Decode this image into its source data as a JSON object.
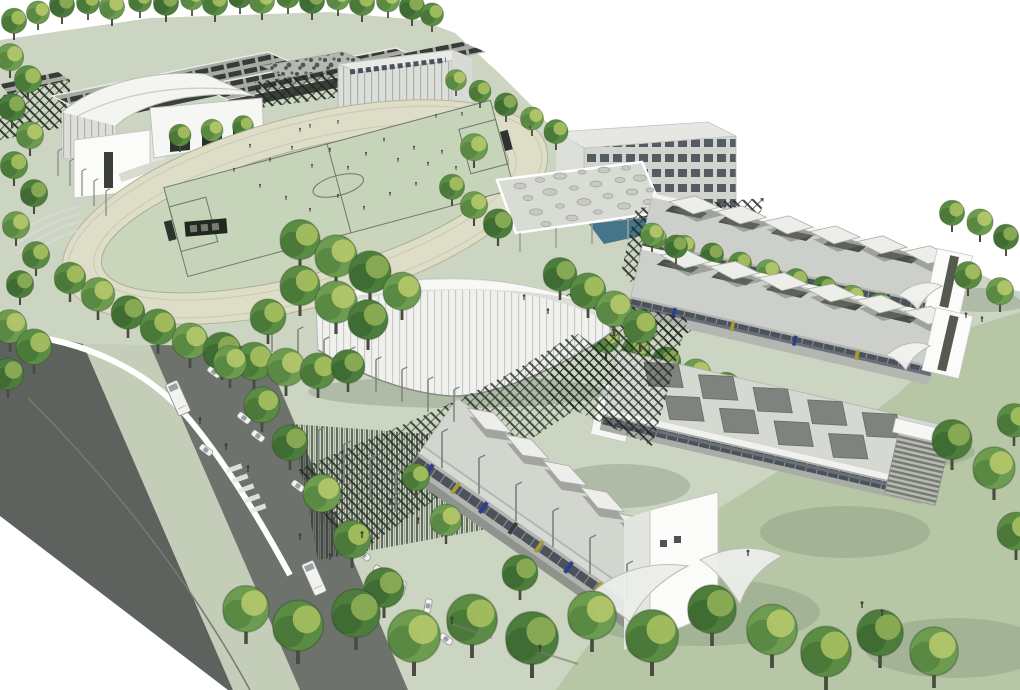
{
  "meta": {
    "type": "architectural-aerial-rendering",
    "width": 1020,
    "height": 690
  },
  "palette": {
    "sky": "#ffffff",
    "ground": "#ccd5c1",
    "lawn": "#b7c6a4",
    "shadow": "#8b9c84",
    "road": "#5e625e",
    "roadLight": "#6e726d",
    "median": "#c3cdb8",
    "track": "#dedec8",
    "infield": "#c9d6bc",
    "pitch": "#c6d4ba",
    "pitchLine": "#6f7866",
    "pool": "#45758a",
    "hatch": "#1f281f",
    "bldgWhite": "#fbfbf9",
    "bldgShade": "#e3e5e0",
    "roofGray": "#cdcfca",
    "stripDark": "#383c38",
    "glass": "#4c525a",
    "accentBlue": "#2e3e8e",
    "accentYellow": "#a69b35",
    "figure": "#3c4240",
    "trunk": "#4a4a42",
    "tree": "#5b8c44",
    "treeLight": "#a6c060",
    "treeDark": "#3e6a31",
    "tree2": "#6d9c50",
    "tree2Light": "#b6c96c",
    "tree2Dark": "#4a7a38",
    "tree3": "#4d7d3c",
    "tree3Light": "#8fae55",
    "tree3Dark": "#335f2a"
  },
  "scene": {
    "areas": [
      "sky",
      "campus-grounds",
      "athletics-track",
      "football-pitch",
      "terrace-seating",
      "rooflit-blocks",
      "sports-hall",
      "leisure-centre",
      "arched-pavilion",
      "swimming-pool-hall",
      "pool-canopy",
      "outdoor-pool",
      "louvre-screens",
      "oval-arena",
      "teaching-block-1",
      "teaching-block-2",
      "teaching-block-3",
      "entrance-building",
      "tensile-canopies",
      "access-road",
      "central-median",
      "parking-lane",
      "pedestrian-crossing",
      "tree-avenues",
      "lawns",
      "cars",
      "buses",
      "light-masts",
      "people",
      "football-players",
      "goal",
      "dugout"
    ]
  }
}
